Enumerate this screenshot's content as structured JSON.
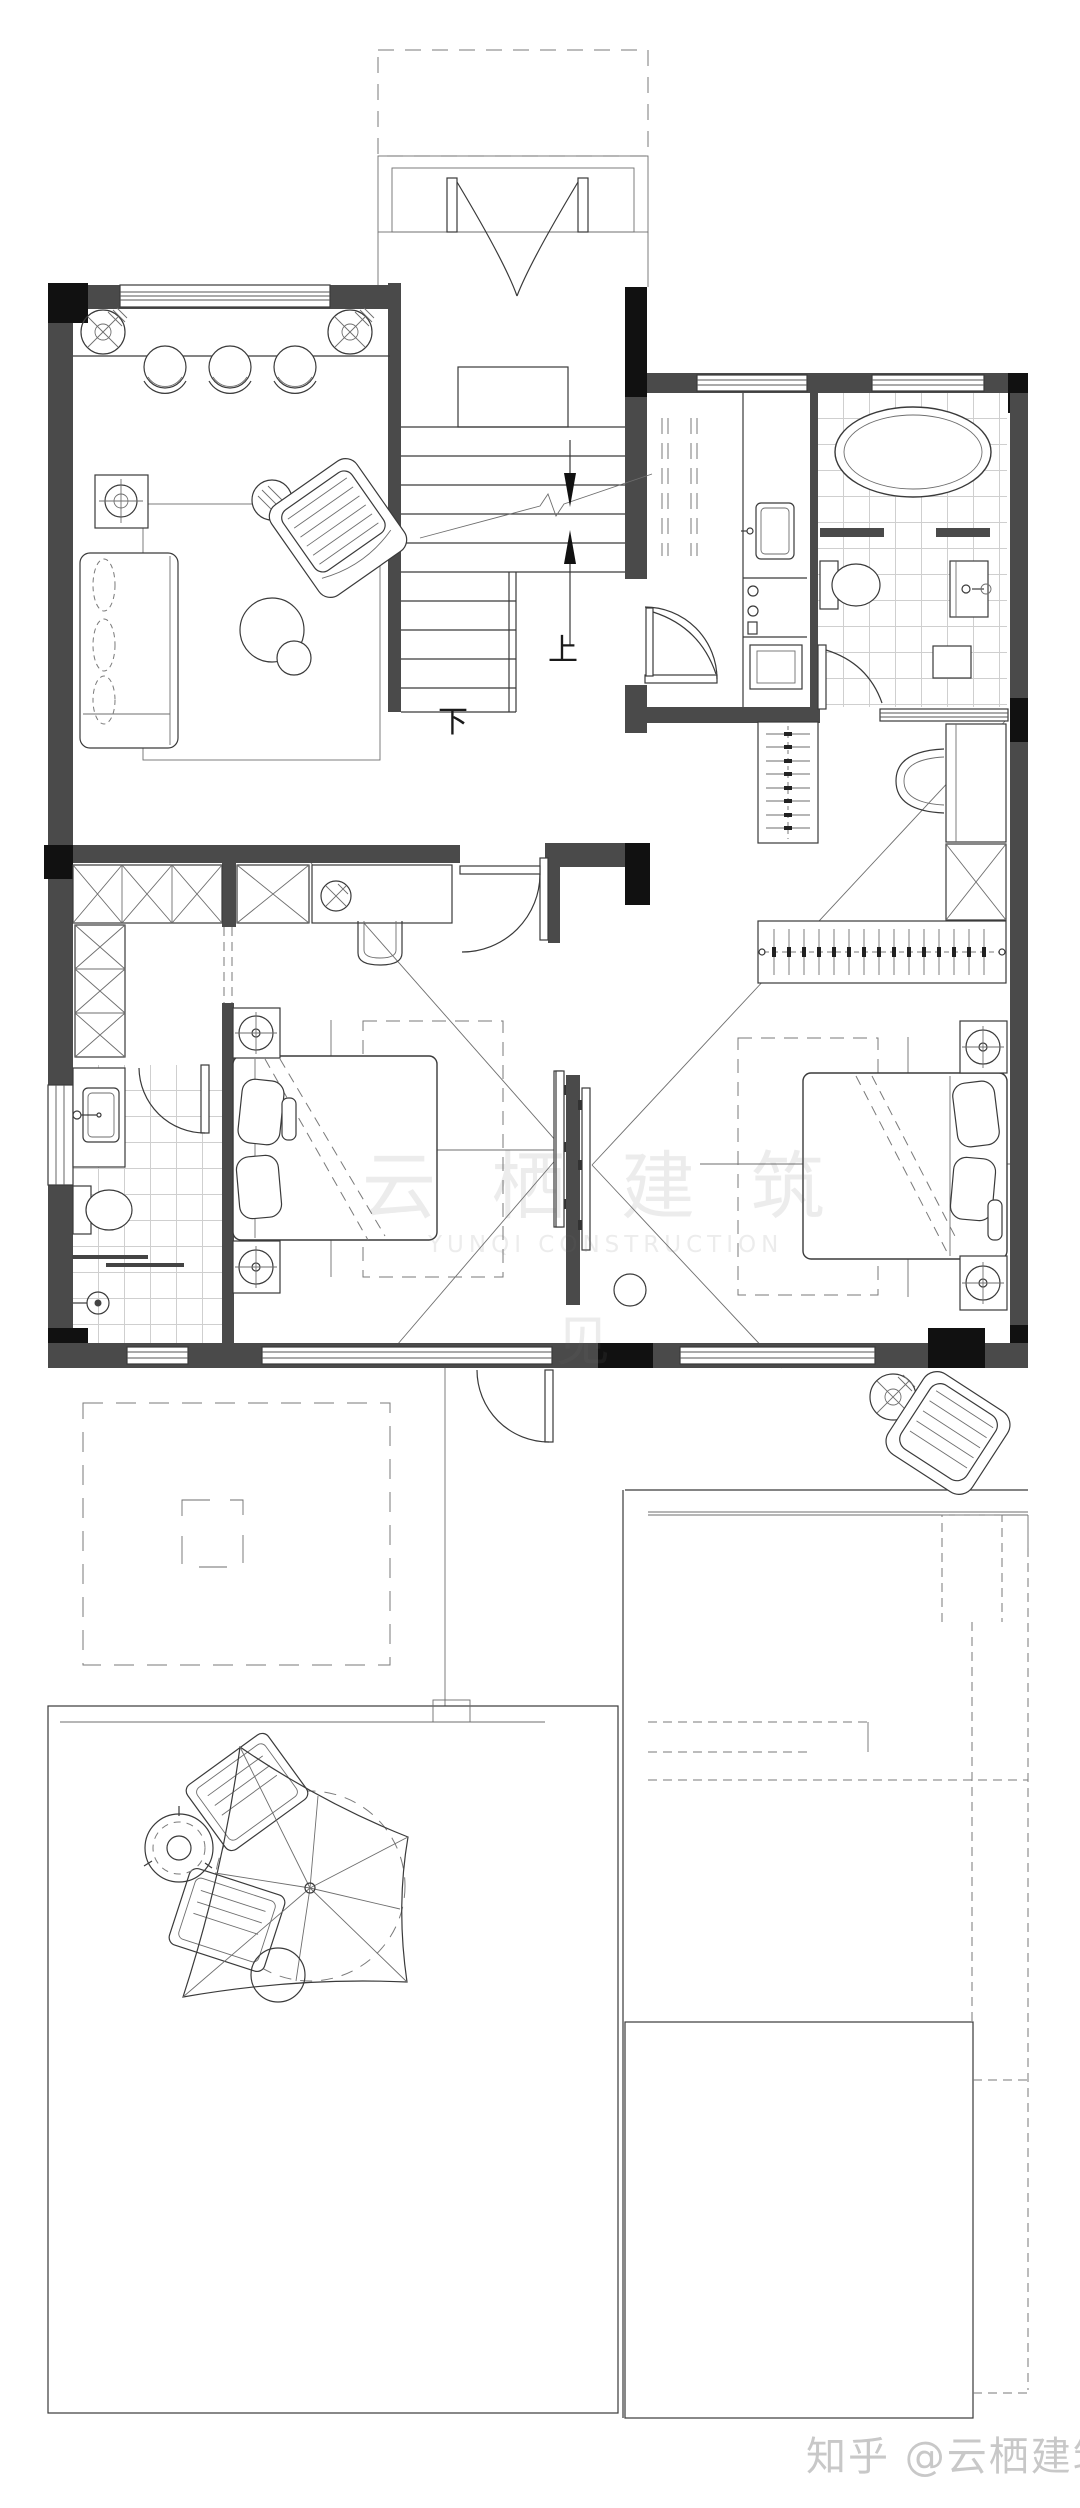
{
  "meta": {
    "description": "Black-and-white residential CAD floor plan (upper storey) with stair, living area, laundry, two bathrooms, two bedrooms with dressing areas, balconies and roof terraces with patio umbrella"
  },
  "labels": {
    "stairs_up": "上",
    "stairs_down": "下"
  },
  "watermark": {
    "credit": "知乎 @云栖建筑",
    "faint_cn": "云 栖 建 筑",
    "faint_en": "YUNQI CONSTRUCTION",
    "faint_char": "见"
  },
  "colors": {
    "background": "#ffffff",
    "wall_fill": "#4a4a4a",
    "wall_dark": "#111111",
    "line": "#3a3a3a",
    "tile_grid": "#cfcfcf",
    "watermark": "#c8c8c8"
  }
}
